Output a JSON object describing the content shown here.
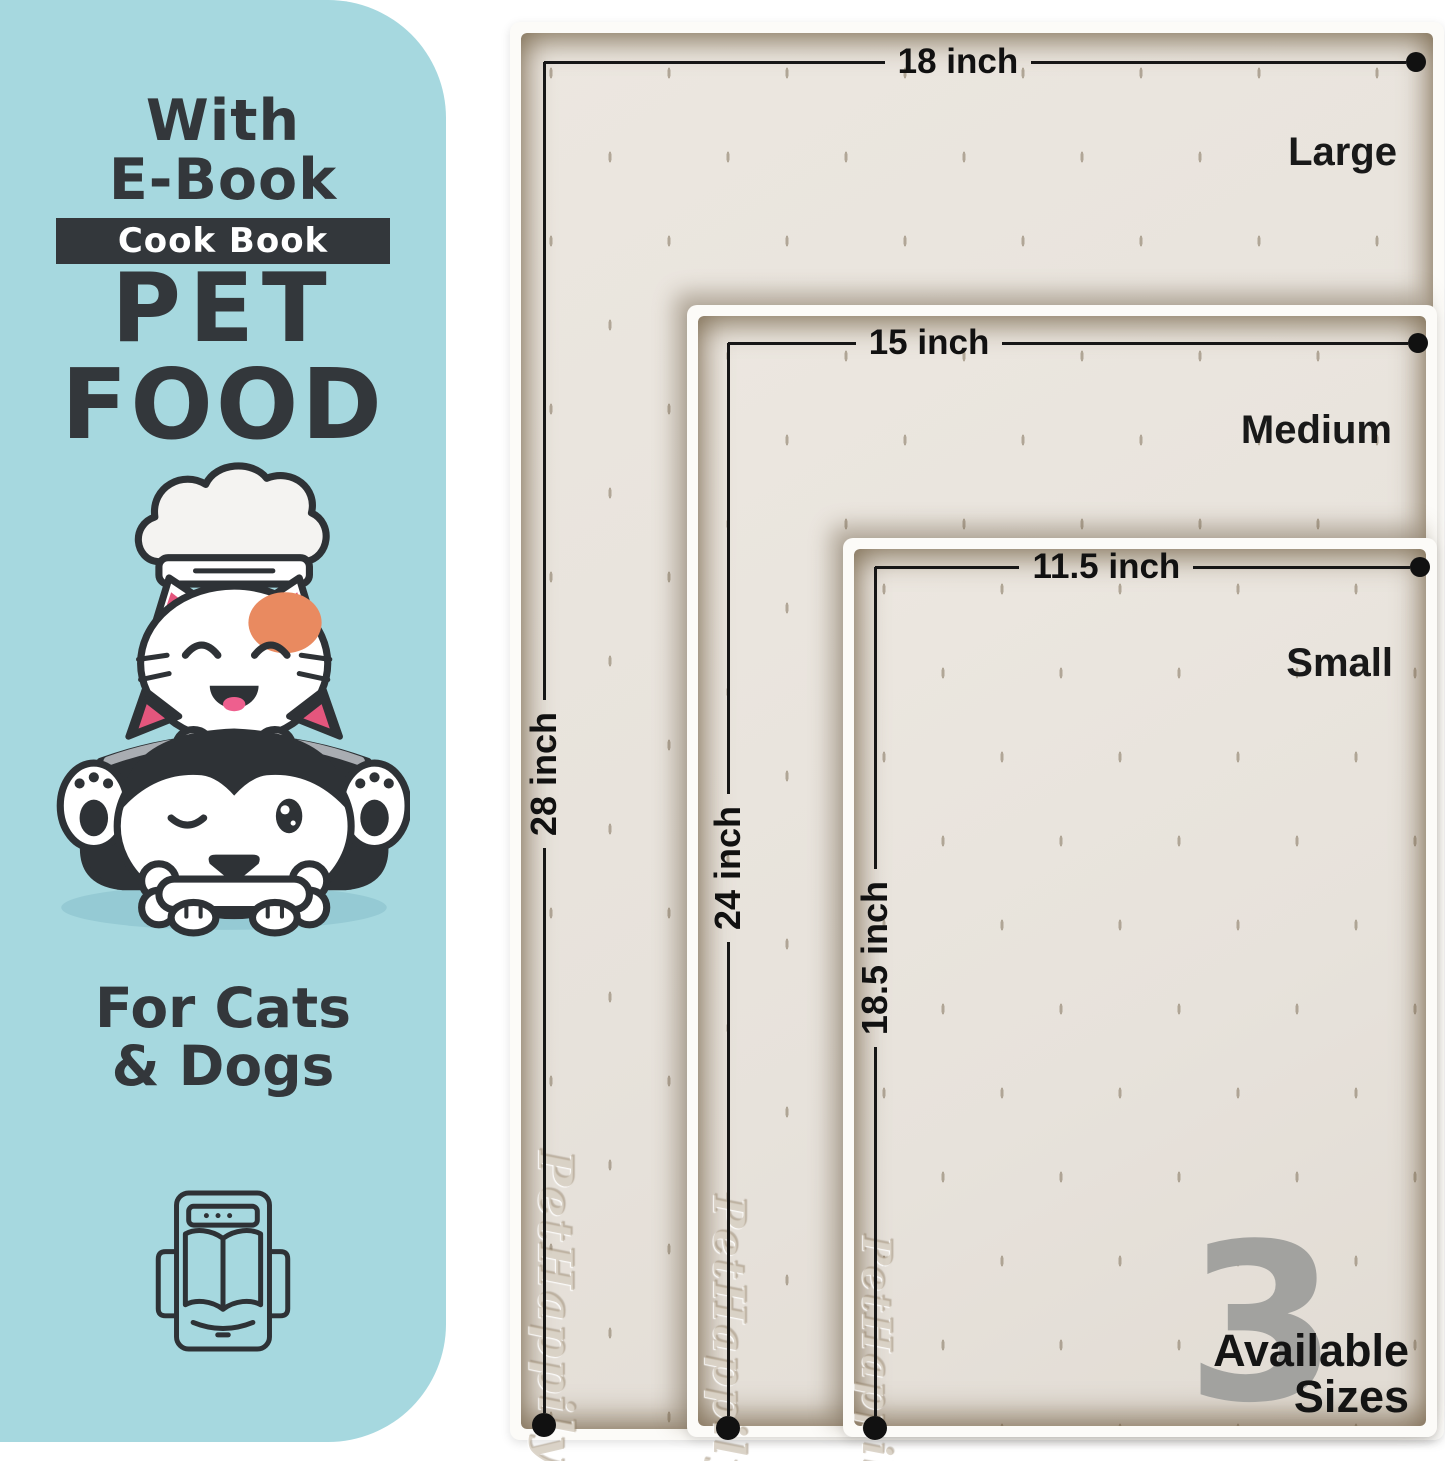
{
  "colors": {
    "panel_bg": "#a6d8df",
    "text_dark": "#33373b",
    "badge_bg": "#33373b",
    "badge_text": "#ffffff",
    "mat_frame": "#fcfbf8",
    "mat_surface": "#e9e4dd",
    "dimension_line": "#161616",
    "big_number_gray": "#a2a29f",
    "cat_patch_orange": "#e98a60",
    "ear_pink": "#e4567d"
  },
  "panel": {
    "heading_line1": "With",
    "heading_line2": "E-Book",
    "badge": "Cook Book",
    "title_line1": "PET",
    "title_line2": "FOOD",
    "subtitle_line1": "For Cats",
    "subtitle_line2": "& Dogs",
    "illustration": "cat-chef-and-husky-dog-with-bone",
    "icon": "ebook-tablet-open-book-icon"
  },
  "mats": [
    {
      "size_name": "Large",
      "width_label": "18 inch",
      "height_label": "28 inch"
    },
    {
      "size_name": "Medium",
      "width_label": "15 inch",
      "height_label": "24 inch"
    },
    {
      "size_name": "Small",
      "width_label": "11.5 inch",
      "height_label": "18.5 inch"
    }
  ],
  "watermark": "PetHappily",
  "sizes_badge": {
    "count": "3",
    "line1": "Available",
    "line2": "Sizes"
  }
}
